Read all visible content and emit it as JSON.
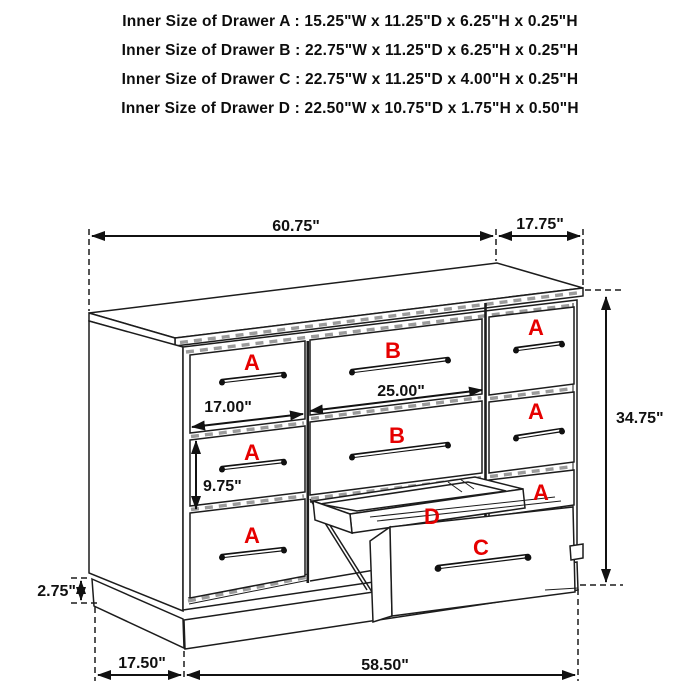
{
  "title_block": {
    "lines": [
      "Inner Size of Drawer A : 15.25\"W x 11.25\"D x 6.25\"H x 0.25\"H",
      "Inner Size of Drawer B : 22.75\"W x 11.25\"D x 6.25\"H x 0.25\"H",
      "Inner Size of Drawer C : 22.75\"W x 11.25\"D x 4.00\"H x 0.25\"H",
      "Inner Size of Drawer D : 22.50\"W x 10.75\"D x 1.75\"H x 0.50\"H"
    ]
  },
  "diagram": {
    "labels": {
      "a": "A",
      "b": "B",
      "c": "C",
      "d": "D"
    },
    "dimensions": {
      "overall_width": "60.75\"",
      "side_depth": "17.75\"",
      "overall_height": "34.75\"",
      "drawer_b_width": "25.00\"",
      "drawer_a_width": "17.00\"",
      "drawer_a_height": "9.75\"",
      "base_height": "2.75\"",
      "base_side": "17.50\"",
      "base_width": "58.50\""
    }
  },
  "colors": {
    "line": "#1c1c1c",
    "label_red": "#e60000",
    "dim_text": "#111111",
    "background": "#ffffff"
  }
}
